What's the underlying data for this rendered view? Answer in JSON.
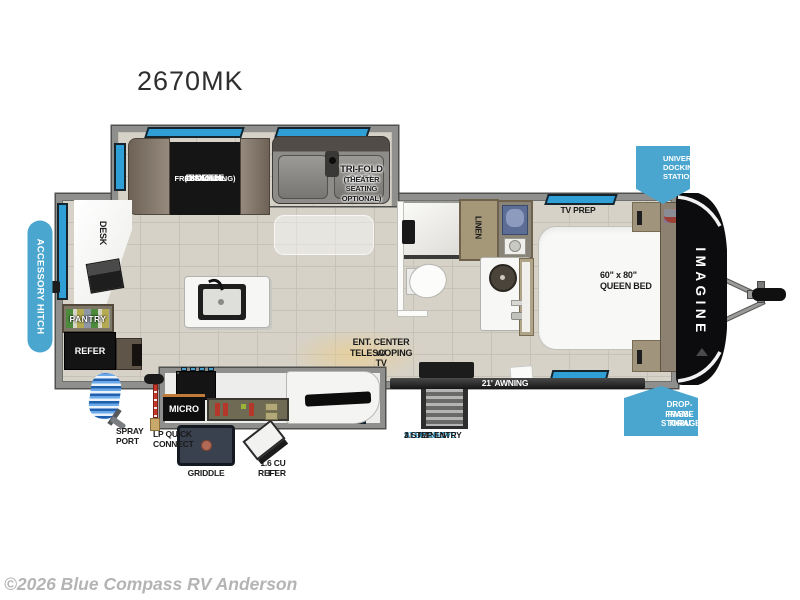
{
  "model": "2670MK",
  "watermark": "©2026 Blue Compass RV Anderson",
  "brand": "IMAGINE",
  "badges": {
    "accessory_hitch": "ACCESSORY HITCH",
    "universal_docking": [
      "UNIVERSAL",
      "DOCKING",
      "STATION"
    ],
    "drop_frame": [
      "DROP-FRAME",
      "PASS-THRU",
      "STORAGE"
    ]
  },
  "labels": {
    "booth_dinette": [
      "BOOTH",
      "DINETTE",
      "(OPTIONAL",
      "FREESTANDING)"
    ],
    "trifold_sofa": [
      "TRI-FOLD SOFA",
      "(THEATER SEATING OPTIONAL)"
    ],
    "desk": "DESK",
    "pantry": "PANTRY",
    "refer": "REFER",
    "linen": "LINEN",
    "tv_prep": "TV PREP",
    "queen_bed": [
      "60\" x 80\"",
      "QUEEN BED"
    ],
    "ent_center": [
      "ENT. CENTER w/",
      "TELESCOPING TV"
    ],
    "micro": "MICRO",
    "awning": "21' AWNING",
    "spray_port": [
      "SPRAY",
      "PORT"
    ],
    "lp_quick_connect": [
      "LP QUICK",
      "CONNECT"
    ],
    "griddle": "GRIDDLE",
    "mini_refer": [
      "1.6 CU FT",
      "REFER"
    ],
    "entry_steps": [
      "ALUMINUM",
      "STEP ABOVE",
      "3 STEP ENTRY"
    ]
  },
  "colors": {
    "badge_blue": "#4aa6cf",
    "window_blue": "#2f9fd6",
    "step_above_text_blue": "#35a0d2",
    "wall_gray": "#8f8f8d",
    "floor_tile": "#d6d2c8",
    "cap_black": "#0c0c0e",
    "watermark_gray": "#b4b4b4"
  }
}
